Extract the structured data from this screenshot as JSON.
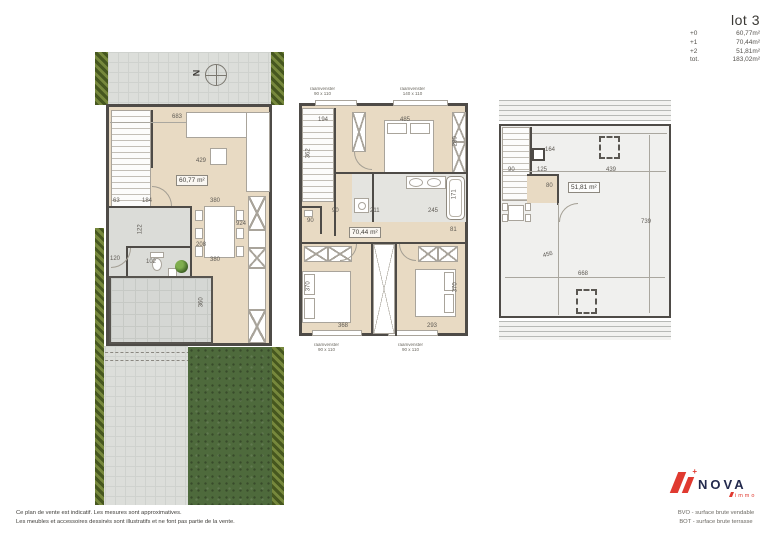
{
  "header": {
    "lot_label": "lot 3",
    "areas": [
      {
        "level": "+0",
        "value": "60,77m²"
      },
      {
        "level": "+1",
        "value": "70,44m²"
      },
      {
        "level": "+2",
        "value": "51,81m²"
      },
      {
        "level": "tot.",
        "value": "183,02m²"
      }
    ]
  },
  "compass": {
    "letter": "N"
  },
  "colors": {
    "brand_red": "#e03a30",
    "brand_navy": "#232a4d",
    "floor_beige": "#e8dac3",
    "wall_gray": "#4e4b47",
    "lawn_green": "#4e6a3c",
    "paving_gray": "#dcdeda"
  },
  "plans": {
    "ground": {
      "title": "ground floor +0",
      "area_label": "60,77 m²"
    },
    "first": {
      "title": "first floor +1",
      "area_label": "70,44 m²"
    },
    "second": {
      "title": "roof terrace +2",
      "area_label": "51,81 m²"
    }
  },
  "annotations": {
    "ground": [
      {
        "t": "683",
        "x": 172,
        "y": 114
      },
      {
        "t": "429",
        "x": 196,
        "y": 158
      },
      {
        "t": "60,77 m²",
        "x": 176,
        "y": 175,
        "cls": "areabox"
      },
      {
        "t": "63",
        "x": 113,
        "y": 198
      },
      {
        "t": "184",
        "x": 142,
        "y": 198
      },
      {
        "t": "380",
        "x": 210,
        "y": 198
      },
      {
        "t": "122",
        "x": 136,
        "y": 226,
        "r": -90
      },
      {
        "t": "924",
        "x": 236,
        "y": 221
      },
      {
        "t": "208",
        "x": 196,
        "y": 242
      },
      {
        "t": "120",
        "x": 110,
        "y": 256
      },
      {
        "t": "102",
        "x": 146,
        "y": 259
      },
      {
        "t": "380",
        "x": 210,
        "y": 257
      },
      {
        "t": "360",
        "x": 197,
        "y": 299,
        "r": -90
      }
    ],
    "first": [
      {
        "t": "raamvenster\n90 x 110",
        "x": 310,
        "y": 87,
        "cls": "winlbl"
      },
      {
        "t": "raamvenster\n140 x 110",
        "x": 400,
        "y": 87,
        "cls": "winlbl"
      },
      {
        "t": "194",
        "x": 318,
        "y": 117
      },
      {
        "t": "485",
        "x": 400,
        "y": 117
      },
      {
        "t": "362",
        "x": 304,
        "y": 150,
        "r": -90
      },
      {
        "t": "280",
        "x": 451,
        "y": 138,
        "r": -90
      },
      {
        "t": "90",
        "x": 332,
        "y": 208
      },
      {
        "t": "211",
        "x": 370,
        "y": 208
      },
      {
        "t": "245",
        "x": 428,
        "y": 208
      },
      {
        "t": "171",
        "x": 450,
        "y": 191,
        "r": -90
      },
      {
        "t": "90",
        "x": 307,
        "y": 218
      },
      {
        "t": "70,44 m²",
        "x": 349,
        "y": 227,
        "cls": "areabox"
      },
      {
        "t": "81",
        "x": 450,
        "y": 227
      },
      {
        "t": "370",
        "x": 304,
        "y": 283,
        "r": -90
      },
      {
        "t": "370",
        "x": 451,
        "y": 284,
        "r": -90
      },
      {
        "t": "368",
        "x": 338,
        "y": 323
      },
      {
        "t": "293",
        "x": 427,
        "y": 323
      },
      {
        "t": "raamvenster\n90 x 110",
        "x": 314,
        "y": 343,
        "cls": "winlbl"
      },
      {
        "t": "raamvenster\n90 x 110",
        "x": 398,
        "y": 343,
        "cls": "winlbl"
      }
    ],
    "second": [
      {
        "t": "164",
        "x": 545,
        "y": 147
      },
      {
        "t": "90",
        "x": 508,
        "y": 167
      },
      {
        "t": "125",
        "x": 537,
        "y": 167
      },
      {
        "t": "439",
        "x": 606,
        "y": 167
      },
      {
        "t": "80",
        "x": 546,
        "y": 183
      },
      {
        "t": "51,81 m²",
        "x": 568,
        "y": 182,
        "cls": "areabox"
      },
      {
        "t": "739",
        "x": 641,
        "y": 219
      },
      {
        "t": "456",
        "x": 543,
        "y": 252,
        "r": -15
      },
      {
        "t": "668",
        "x": 578,
        "y": 271
      }
    ]
  },
  "footer": {
    "disclaimer": [
      "Ce plan de vente est indicatif. Les mesures sont approximatives.",
      "Les meubles et accessoires dessinés sont illustratifs et ne font pas partie de la vente."
    ],
    "legend": [
      "BVO - surface brute vendable",
      "BOT - surface brute terrasse"
    ],
    "logo": {
      "brand": "NOVA",
      "sub": "immo"
    }
  }
}
